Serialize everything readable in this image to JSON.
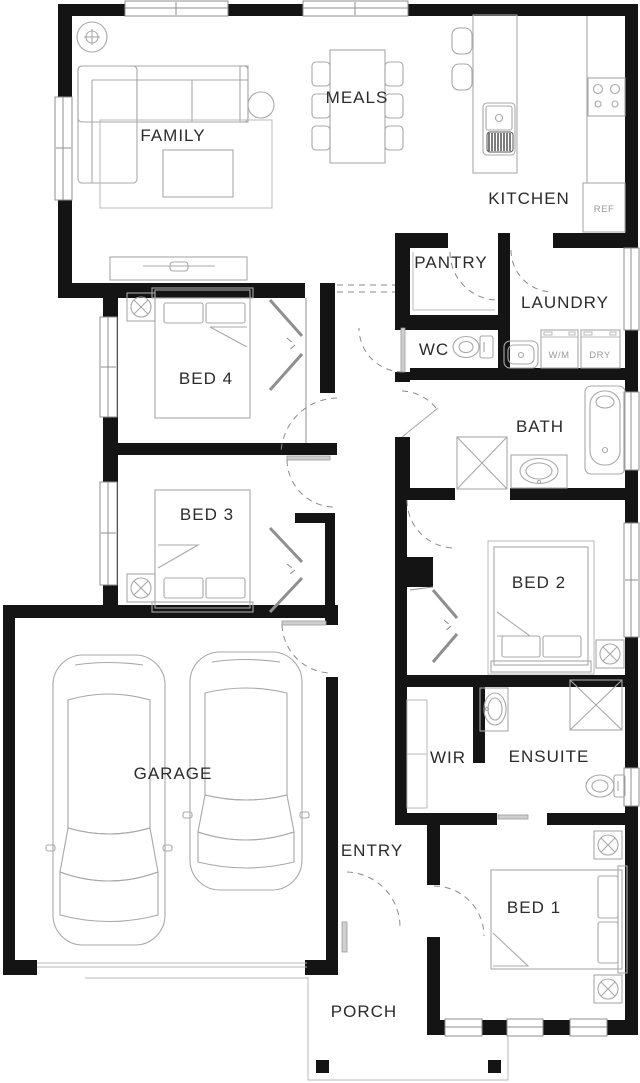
{
  "floor_plan": {
    "title": "Single storey house floor plan",
    "rooms": {
      "family": {
        "label": "FAMILY"
      },
      "meals": {
        "label": "MEALS"
      },
      "kitchen": {
        "label": "KITCHEN"
      },
      "pantry": {
        "label": "PANTRY"
      },
      "laundry": {
        "label": "LAUNDRY"
      },
      "wc": {
        "label": "WC"
      },
      "bath": {
        "label": "BATH"
      },
      "bed4": {
        "label": "BED 4"
      },
      "bed3": {
        "label": "BED 3"
      },
      "bed2": {
        "label": "BED 2"
      },
      "garage": {
        "label": "GARAGE"
      },
      "wir": {
        "label": "WIR"
      },
      "ensuite": {
        "label": "ENSUITE"
      },
      "entry": {
        "label": "ENTRY"
      },
      "bed1": {
        "label": "BED 1"
      },
      "porch": {
        "label": "PORCH"
      }
    },
    "appliances": {
      "fridge": "REF",
      "washing_machine": "W/M",
      "dryer": "DRY"
    },
    "colors": {
      "wall": "#141414",
      "furniture_line": "#a8a8a8",
      "door_arc": "#8a8a8a",
      "background": "#ffffff"
    }
  }
}
